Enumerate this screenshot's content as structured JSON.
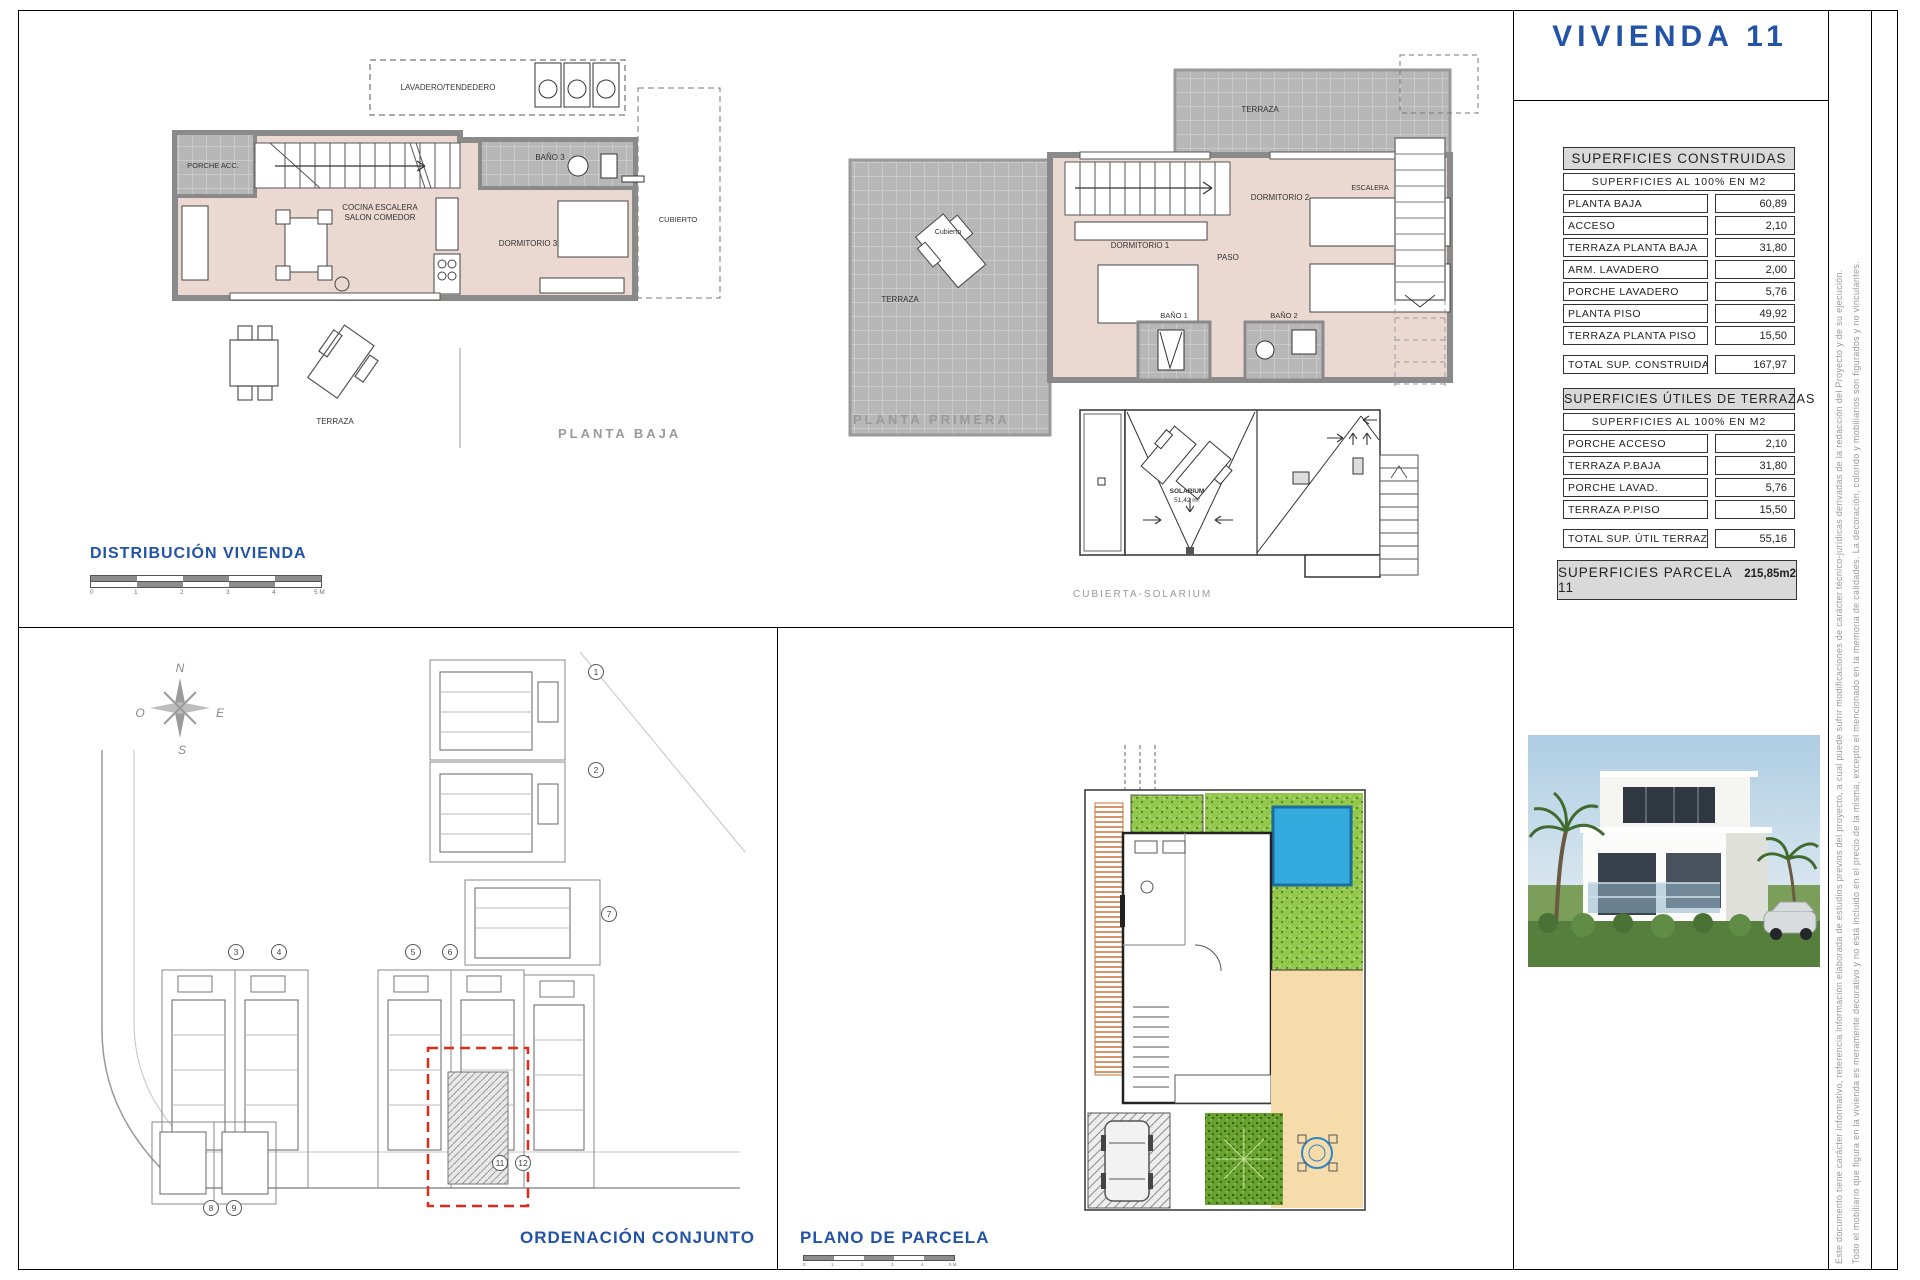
{
  "panel": {
    "title": "VIVIENDA 11",
    "construidas": {
      "title": "SUPERFICIES CONSTRUIDAS",
      "subtitle": "SUPERFICIES AL 100% EN M2",
      "rows": [
        {
          "label": "PLANTA BAJA",
          "value": "60,89"
        },
        {
          "label": "ACCESO",
          "value": "2,10"
        },
        {
          "label": "TERRAZA PLANTA BAJA",
          "value": "31,80"
        },
        {
          "label": "ARM. LAVADERO",
          "value": "2,00"
        },
        {
          "label": "PORCHE LAVADERO",
          "value": "5,76"
        },
        {
          "label": "PLANTA PISO",
          "value": "49,92"
        },
        {
          "label": "TERRAZA PLANTA PISO",
          "value": "15,50"
        }
      ],
      "total_label": "TOTAL SUP. CONSTRUIDA:",
      "total_value": "167,97"
    },
    "terrazas": {
      "title": "SUPERFICIES ÚTILES DE TERRAZAS",
      "subtitle": "SUPERFICIES AL 100% EN M2",
      "rows": [
        {
          "label": "PORCHE ACCESO",
          "value": "2,10"
        },
        {
          "label": "TERRAZA P.BAJA",
          "value": "31,80"
        },
        {
          "label": "PORCHE LAVAD.",
          "value": "5,76"
        },
        {
          "label": "TERRAZA P.PISO",
          "value": "15,50"
        }
      ],
      "total_label": "TOTAL SUP. ÚTIL TERRAZAS:",
      "total_value": "55,16"
    },
    "parcela": {
      "label": "SUPERFICIES PARCELA 11",
      "value": "215,85m2"
    }
  },
  "plans": {
    "planta_baja": {
      "caption": "PLANTA BAJA",
      "lavadero": "LAVADERO/TENDEDERO",
      "porche": "PORCHE ACC.",
      "bano3": "BAÑO 3",
      "cocina_l1": "COCINA ESCALERA",
      "cocina_l2": "SALON COMEDOR",
      "dorm3": "DORMITORIO 3",
      "cubierto": "CUBIERTO",
      "terraza": "TERRAZA"
    },
    "planta_primera": {
      "caption": "PLANTA PRIMERA",
      "terraza_top": "TERRAZA",
      "terraza_left": "TERRAZA",
      "cubierto": "Cubierto",
      "dorm1": "DORMITORIO 1",
      "dorm2": "DORMITORIO 2",
      "paso": "PASO",
      "bano1": "BAÑO 1",
      "bano2": "BAÑO 2",
      "escalera": "ESCALERA"
    },
    "solarium": {
      "caption": "CUBIERTA-SOLARIUM",
      "label_l1": "SOLARIUM",
      "label_l2": "51,42 m²"
    }
  },
  "distribucion": {
    "label": "DISTRIBUCIÓN VIVIENDA",
    "scale_ticks": [
      "0",
      "1",
      "2",
      "3",
      "4",
      "5 M"
    ]
  },
  "site": {
    "caption": "ORDENACIÓN CONJUNTO",
    "numbers": [
      "1",
      "2",
      "3",
      "4",
      "5",
      "6",
      "7",
      "8",
      "9",
      "11",
      "12"
    ],
    "compass": {
      "n": "N",
      "e": "E",
      "s": "S",
      "o": "O"
    }
  },
  "parcel": {
    "caption": "PLANO DE PARCELA",
    "scale_ticks": [
      "0",
      "1",
      "2",
      "3",
      "4",
      "5 M"
    ]
  },
  "disclaimer": {
    "line1": "Este documento tiene carácter informativo, referencia información elaborada de estudios previos del proyecto, a cual puede sufrir modificaciones de carácter técnico-jurídicas derivadas de la redacción del Proyecto y de su ejecución.",
    "line2": "Todo el mobiliario que figura en la vivienda es meramente decorativo y no está incluido en el precio de la misma, excepto el mencionado en la memoria de calidades. La decoración, colorido y mobiliarios son figurados y no vinculantes."
  }
}
